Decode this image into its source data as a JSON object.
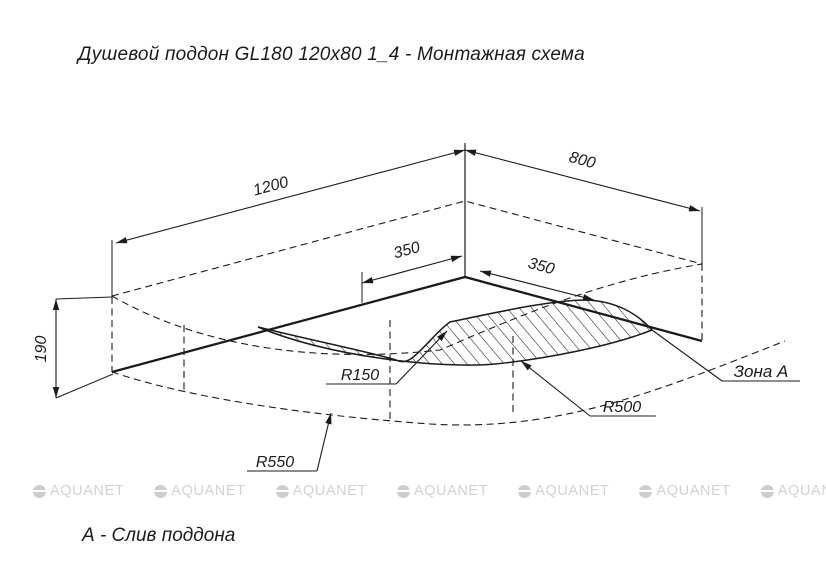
{
  "title": "Душевой поддон GL180 120x80 1_4 - Монтажная схема",
  "footnote": "А - Слив поддона",
  "watermark": {
    "text": "AQUANET",
    "count": 8,
    "color": "#d2d2d2"
  },
  "drawing": {
    "dimensions": {
      "length": "1200",
      "width": "800",
      "height": "190",
      "zone_offset_left": "350",
      "zone_offset_right": "350"
    },
    "radii": {
      "inner": "R150",
      "middle": "R500",
      "outer": "R550"
    },
    "zone_label": "Зона A",
    "line_color": "#1b1b1b",
    "background": "#ffffff"
  }
}
